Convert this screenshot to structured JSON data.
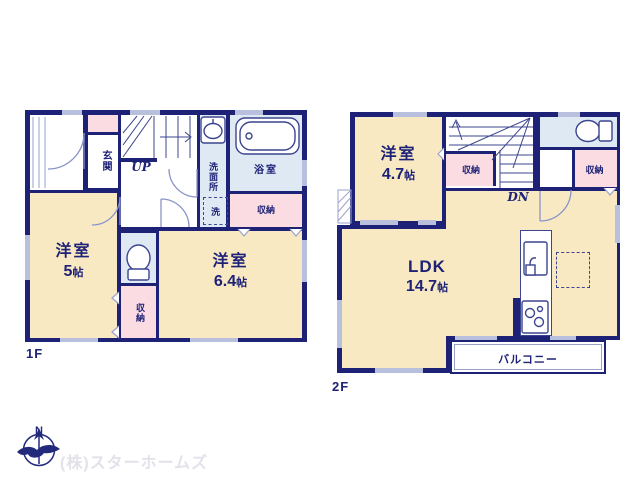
{
  "floor1": {
    "label": "1F",
    "rooms": {
      "genkan": {
        "label": "玄関"
      },
      "stairs_label": "UP",
      "washroom": {
        "label": "洗面所",
        "washer": "洗"
      },
      "bathroom": {
        "label": "浴室"
      },
      "bath_closet": {
        "label": "収納"
      },
      "bedroom_a": {
        "name": "洋室",
        "size": "5",
        "unit": "帖"
      },
      "toilet_closet": {
        "label": "収納"
      },
      "bedroom_b": {
        "name": "洋室",
        "size": "6.4",
        "unit": "帖"
      }
    }
  },
  "floor2": {
    "label": "2F",
    "rooms": {
      "bedroom": {
        "name": "洋室",
        "size": "4.7",
        "unit": "帖"
      },
      "stairs_label": "DN",
      "stair_closet": {
        "label": "収納"
      },
      "side_closet": {
        "label": "収納"
      },
      "ldk": {
        "name": "LDK",
        "size": "14.7",
        "unit": "帖"
      },
      "balcony": {
        "label": "バルコニー"
      }
    }
  },
  "footer": {
    "company": "(株)スターホームズ",
    "compass_north": "N"
  },
  "colors": {
    "wall": "#1e2277",
    "room_cream": "#f8e9c3",
    "closet_pink": "#fbdce2",
    "wet_blue": "#dfe9f4",
    "window_mark": "#b9c0de",
    "watermark_gray": "#e2e2ea"
  }
}
